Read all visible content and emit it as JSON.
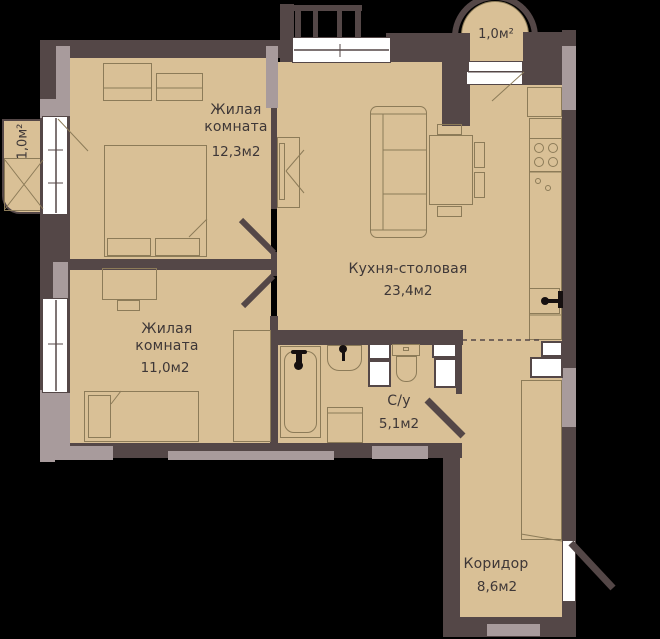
{
  "title": "Apartment floor plan",
  "colors": {
    "wall": "#544747",
    "pillar": "#a89b9c",
    "floor": "#d9c096",
    "line": "#8c7b58",
    "text": "#3e3737",
    "window": "#ffffff",
    "icon": "#161010"
  },
  "rooms": {
    "room1": {
      "name": "Жилая\nкомната",
      "area": "12,3м2"
    },
    "room2": {
      "name": "Жилая\nкомната",
      "area": "11,0м2"
    },
    "kitchen": {
      "name": "Кухня-столовая",
      "area": "23,4м2"
    },
    "bathroom": {
      "name": "С/у",
      "area": "5,1м2"
    },
    "corridor": {
      "name": "Коридор",
      "area": "8,6м2"
    },
    "balcony_left": {
      "area": "1,0м²"
    },
    "balcony_right": {
      "area": "1,0м²"
    }
  }
}
